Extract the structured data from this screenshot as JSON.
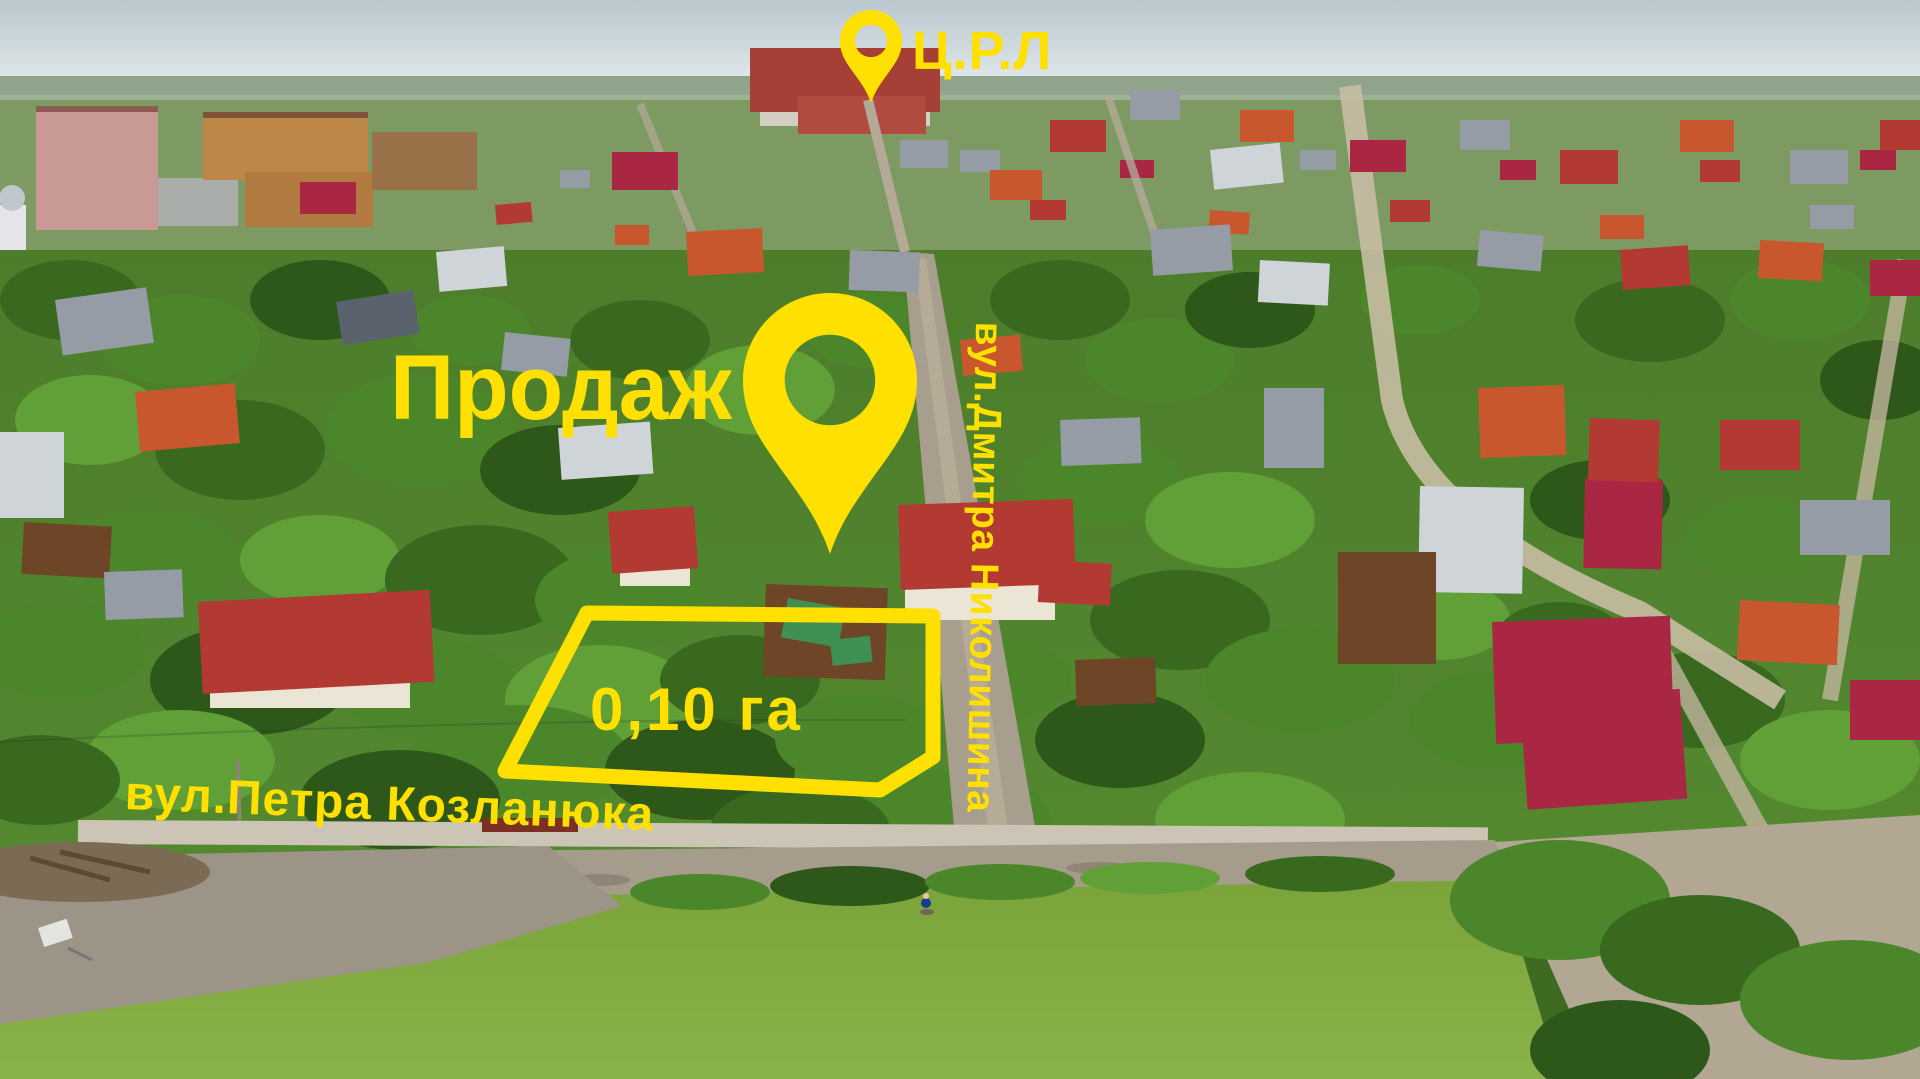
{
  "photo": {
    "accent_color": "#FFE000"
  },
  "annotations": {
    "sale_label": "Продаж",
    "area_label": "0,10 га",
    "poi_label": "Ц.Р.Л",
    "street_bottom": "вул.Петра Козланюка",
    "street_side": "вул.Дмитра Николишина"
  },
  "markers": {
    "parcel_outline_points": "587,613 933,616 933,757 880,790 505,771",
    "sale_pin_transform": "translate(743,293) scale(1.74)",
    "poi_pin_transform": "translate(840,10) scale(0.62)"
  }
}
